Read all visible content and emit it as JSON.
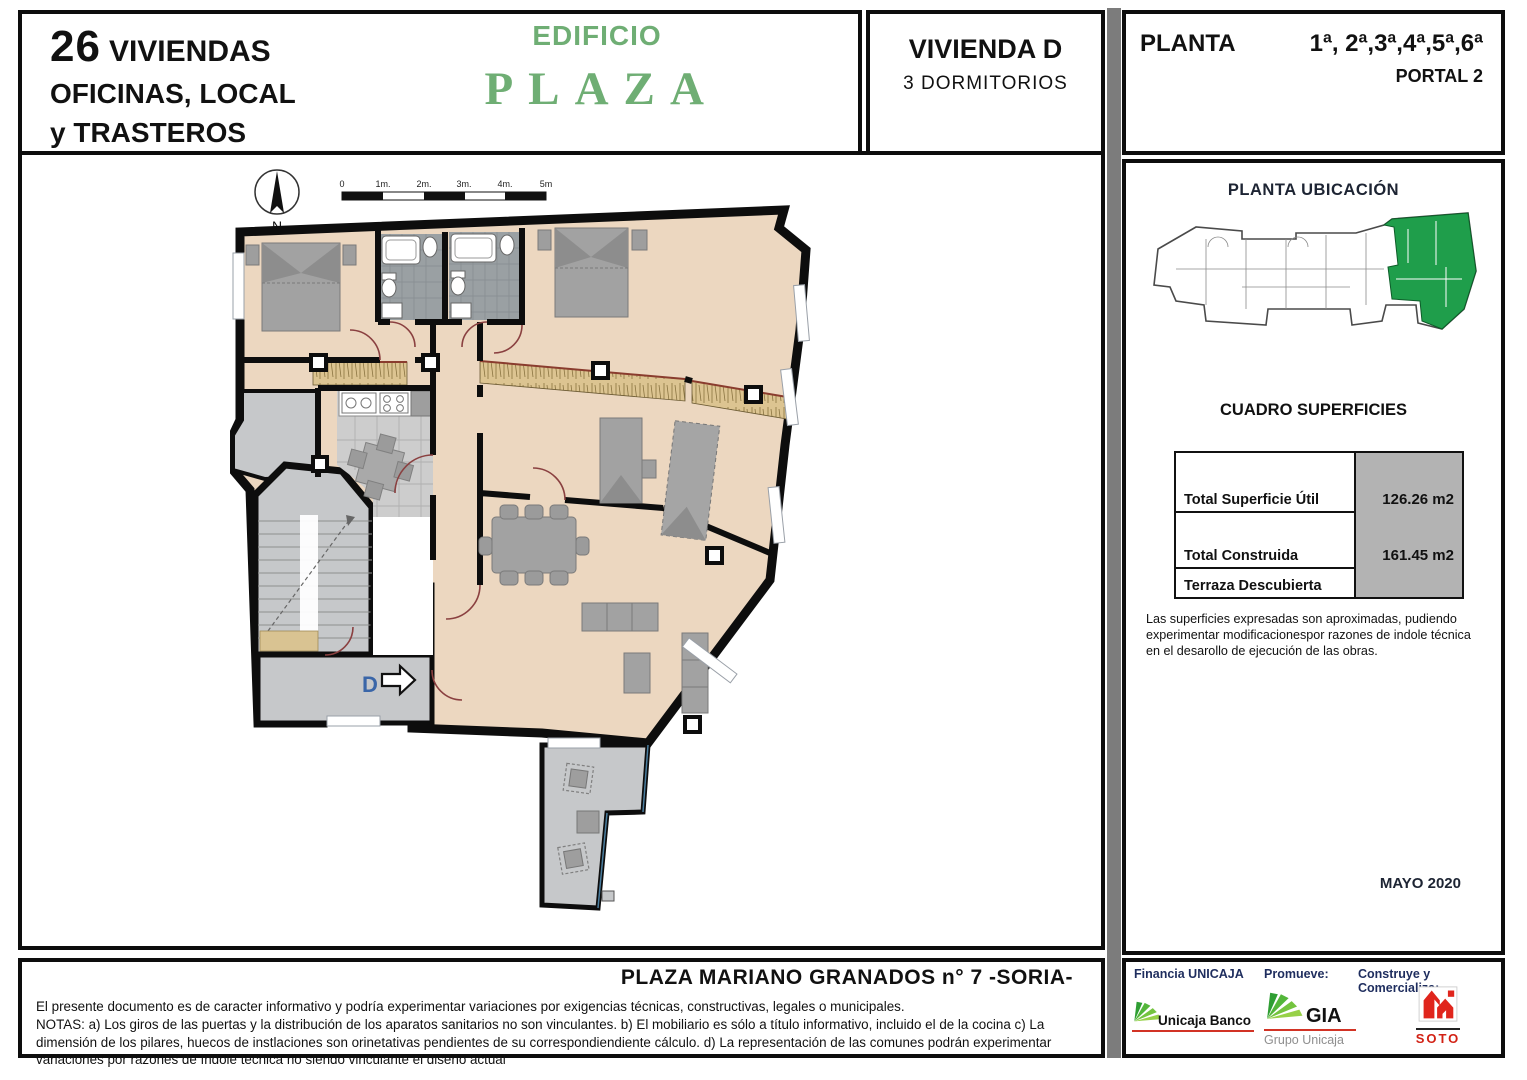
{
  "header": {
    "project": {
      "number": "26",
      "line1": "VIVIENDAS",
      "line2": "OFICINAS, LOCAL",
      "line3": "y TRASTEROS"
    },
    "building": {
      "word1": "EDIFICIO",
      "word2": "PLAZA"
    },
    "unit": {
      "name": "VIVIENDA D",
      "subtitle": "3 DORMITORIOS"
    },
    "floor": {
      "label": "PLANTA",
      "values": "1ª, 2ª,3ª,4ª,5ª,6ª",
      "portal": "PORTAL 2"
    }
  },
  "plan": {
    "north_label": "N",
    "unit_label": "D",
    "scale_labels": [
      "0",
      "1m.",
      "2m.",
      "3m.",
      "4m.",
      "5m"
    ]
  },
  "sidebar": {
    "location_title": "PLANTA UBICACIÓN",
    "surfaces_title": "CUADRO SUPERFICIES",
    "surfaces_rows": [
      {
        "label": "Total Superficie Útil",
        "value": "126.26 m2"
      },
      {
        "label": "Total Construida",
        "value": "161.45 m2"
      },
      {
        "label": "Terraza Descubierta",
        "value": ""
      }
    ],
    "note": "Las superficies expresadas son aproximadas, pudiendo experimentar modificacionespor razones de indole técnica en el desarollo de ejecución de las obras.",
    "date": "MAYO 2020"
  },
  "footer": {
    "address": "PLAZA MARIANO GRANADOS n° 7 -SORIA-",
    "disclaimer_intro": "El presente documento es de caracter informativo y podría experimentar variaciones por exigencias técnicas, constructivas, legales o municipales.",
    "disclaimer_notes": "NOTAS: a) Los giros de las puertas y la distribución de los aparatos sanitarios no son vinculantes. b) El mobiliario es sólo a título informativo, incluido el de la cocina c) La dimensión de los pilares, huecos de instlaciones son orinetativas pendientes de su correspondiendiente cálculo. d) La representación de las comunes podrán experimentar variaciones por razones de índole técnica no siendo vinculante el diseño actual"
  },
  "credits": {
    "financia": "Financia UNICAJA",
    "promueve": "Promueve:",
    "construye": "Construye y Comercializa:",
    "unicaja_name": "Unicaja Banco",
    "gia_name": "GIA",
    "gia_sub": "Grupo Unicaja",
    "soto_name": "SOTO"
  },
  "colors": {
    "brand_green": "#6fae74",
    "highlight_green": "#1f9e4b",
    "floor_tan": "#ecd7c0",
    "wall_black": "#0d0d0d",
    "accent_red": "#d23325",
    "credit_navy": "#1e2d5e",
    "value_gray": "#b3b3b3"
  }
}
